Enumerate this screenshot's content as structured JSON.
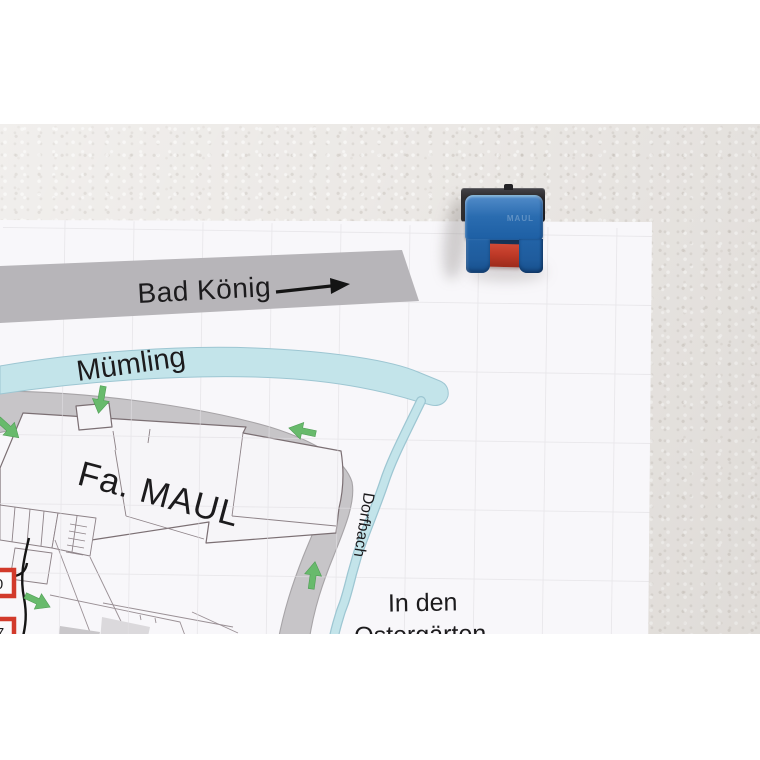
{
  "scene": {
    "wall_color": "#ebe8e5",
    "letterbox_color": "#ffffff",
    "paper_color": "#f8f7fa"
  },
  "map": {
    "highway_label": "Bad König",
    "river_label": "Mümling",
    "company_label": "Fa. MAUL",
    "stream_label": "Dorfbach",
    "street_label_line1": "In den",
    "street_label_line2": "Ostergärten",
    "markers": [
      {
        "label": "0"
      },
      {
        "label": "7"
      }
    ],
    "colors": {
      "highway_band": "#b7b5b9",
      "ring_road": "#c7c5c8",
      "road_edge": "#a7a4a7",
      "water": "#c3e4ea",
      "water_edge": "#9dc6d2",
      "building_fill": "#f6f5f8",
      "building_stroke": "#7b6f73",
      "grid": "#e1dfe3",
      "direction_arrow_green": "#68ba6c",
      "marker_red": "#d23a2b",
      "label_text": "#1c1b1d"
    }
  },
  "clip": {
    "embossed_text": "MAUL",
    "colors": {
      "body_blue": "#2268ac",
      "insert_red": "#bf3a28",
      "plate_dark": "#29282b"
    }
  }
}
